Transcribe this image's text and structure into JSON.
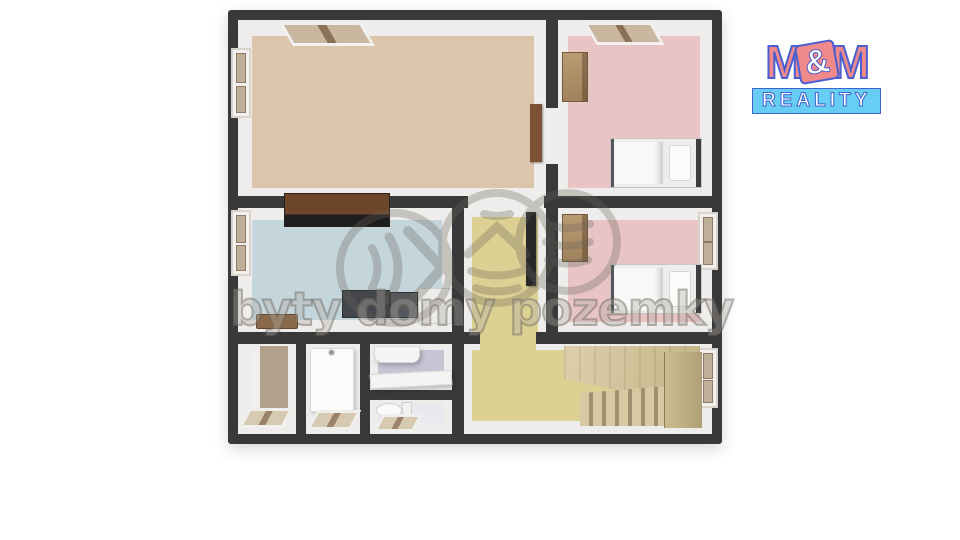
{
  "watermark": {
    "text": "byty domy pozemky",
    "stroke_color": "#6a645a",
    "icons": [
      "sound-waves-icon",
      "house-layers-icon",
      "stacked-bars-icon"
    ]
  },
  "logo": {
    "m_left": "M",
    "ampersand": "&",
    "m_right": "M",
    "reality_label": "REALITY",
    "m_color": "#f0898b",
    "outline_color": "#4a5fd0",
    "reality_bg": "#67cdf2"
  },
  "floorplan": {
    "wall_color": "#39393b",
    "inner_wall_color": "#eeedeb",
    "rooms": {
      "top_left_room": {
        "floor_color": "#dbc6ab"
      },
      "top_right_bedroom": {
        "floor_color": "#e8c5c4"
      },
      "kitchen": {
        "floor_color": "#c4d5dc"
      },
      "corridor": {
        "floor_color": "#dcd092"
      },
      "middle_right_bedroom": {
        "floor_color": "#e8c5c4"
      },
      "closet_room": {
        "floor_color": "#f1f0ee"
      },
      "entry_room": {
        "floor_color": "#f1f0ee"
      },
      "bathroom": {
        "floor_color": "#c6c5d6"
      },
      "wc": {
        "floor_color": "#e9e8ef"
      },
      "stair_hall": {
        "floor_color": "#dcd092"
      }
    },
    "furniture_colors": {
      "wardrobe_wood": "#ad8d64",
      "kitchen_cabinet": "#6e462a",
      "appliance_stove": "#43464a",
      "appliance_oven": "#55585c",
      "fridge": "#ececea",
      "cutting_board": "#8a6a4a",
      "closet_accent_wall": "#b1a08a",
      "door_wood": "#7c5136",
      "corridor_door_dark": "#28282a",
      "stairs_wood": "#cfc09a",
      "bed_linen": "#ededec"
    }
  }
}
